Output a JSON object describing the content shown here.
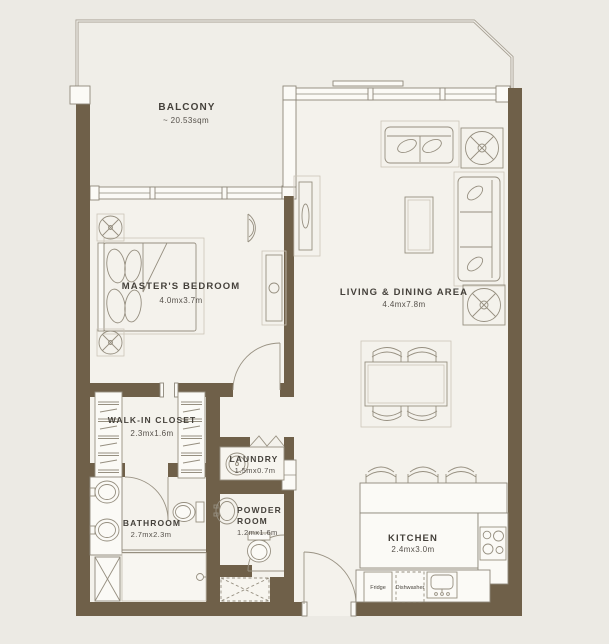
{
  "plan": {
    "rooms": {
      "balcony": {
        "name": "BALCONY",
        "area": "~ 20.53sqm"
      },
      "master_bedroom": {
        "name": "MASTER'S BEDROOM",
        "dims": "4.0mx3.7m"
      },
      "living_dining": {
        "name": "LIVING & DINING AREA",
        "dims": "4.4mx7.8m"
      },
      "walk_in_closet": {
        "name": "WALK-IN CLOSET",
        "dims": "2.3mx1.6m"
      },
      "laundry": {
        "name": "LAUNDRY",
        "dims": "1.5mx0.7m"
      },
      "bathroom": {
        "name": "BATHROOM",
        "dims": "2.7mx2.3m"
      },
      "powder_room": {
        "name_line1": "POWDER",
        "name_line2": "ROOM",
        "dims": "1.2mx1.6m"
      },
      "kitchen": {
        "name": "KITCHEN",
        "dims": "2.4mx3.0m"
      }
    },
    "appliances": {
      "fridge": "Fridge",
      "dishwasher": "Dishwasher"
    },
    "colors": {
      "wall": "#6F6049",
      "background": "#ECEAE4",
      "floor": "#F4F2EC",
      "balcony_floor": "#F0EEE8",
      "fixture_fill": "#FBFAF6",
      "line": "#8E887B",
      "text": "#45413B"
    }
  }
}
